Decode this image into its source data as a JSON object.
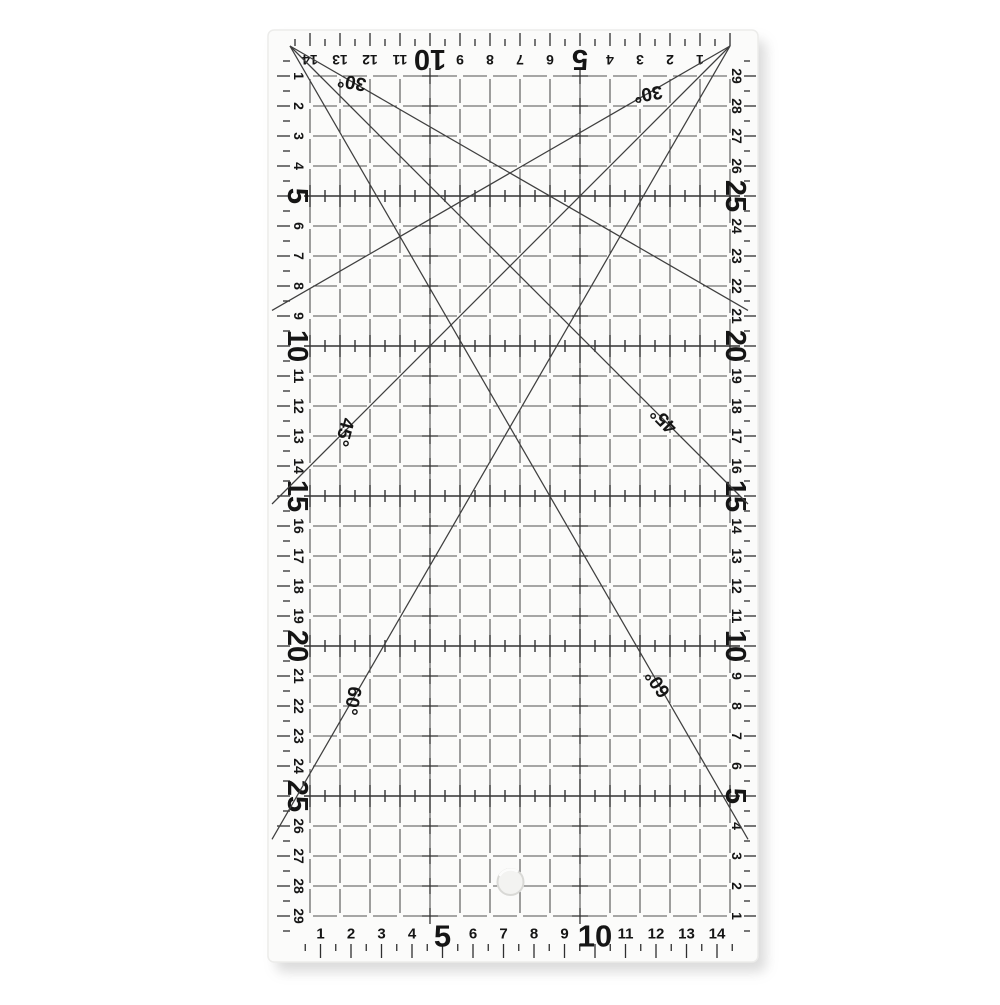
{
  "image_type": "product photo of a transparent acrylic quilting patchwork ruler on a white background",
  "colors": {
    "background": "#ffffff",
    "ruler_fill": "#fbfbfa",
    "ruler_edge": "#ececea",
    "grid_line": "#505050",
    "bold_line": "#333333",
    "tick": "#2f2f2f",
    "number": "#151515",
    "diagonal": "#3f3f3f",
    "shadow": "#9a9a9a",
    "hole_fill": "#f3f3f1",
    "hole_rim": "#d9d9d6"
  },
  "ruler": {
    "top_scale": {
      "direction": "right-to-left",
      "orientation": "upside-down",
      "numbers": [
        1,
        2,
        3,
        4,
        5,
        6,
        7,
        8,
        9,
        10,
        11,
        12,
        13,
        14
      ],
      "bold": [
        5,
        10
      ]
    },
    "bottom_scale": {
      "direction": "left-to-right",
      "orientation": "upright",
      "numbers": [
        1,
        2,
        3,
        4,
        5,
        6,
        7,
        8,
        9,
        10,
        11,
        12,
        13,
        14
      ],
      "bold": [
        5,
        10
      ]
    },
    "left_scale": {
      "direction": "top-to-bottom",
      "orientation": "rotated-90",
      "numbers": [
        1,
        2,
        3,
        4,
        5,
        6,
        7,
        8,
        9,
        10,
        11,
        12,
        13,
        14,
        15,
        16,
        17,
        18,
        19,
        20,
        21,
        22,
        23,
        24,
        25,
        26,
        27,
        28,
        29
      ],
      "bold": [
        5,
        10,
        15,
        20,
        25
      ]
    },
    "right_scale": {
      "direction": "bottom-to-top",
      "orientation": "rotated-90",
      "numbers": [
        1,
        2,
        3,
        4,
        5,
        6,
        7,
        8,
        9,
        10,
        11,
        12,
        13,
        14,
        15,
        16,
        17,
        18,
        19,
        20,
        21,
        22,
        23,
        24,
        25,
        26,
        27,
        28,
        29
      ],
      "bold": [
        5,
        10,
        15,
        20,
        25
      ]
    },
    "tick_cross_rows_left_units": [
      5,
      10,
      15,
      20,
      25
    ],
    "cross_mark_columns_top_units": [
      5,
      10
    ],
    "angle_lines": [
      {
        "label": "30°",
        "from": "top-left"
      },
      {
        "label": "30°",
        "from": "top-right"
      },
      {
        "label": "45°",
        "from": "top-left"
      },
      {
        "label": "45°",
        "from": "top-right"
      },
      {
        "label": "60°",
        "from": "top-left"
      },
      {
        "label": "60°",
        "from": "top-right"
      }
    ],
    "hole": {
      "present": true,
      "location": "bottom-center"
    }
  }
}
